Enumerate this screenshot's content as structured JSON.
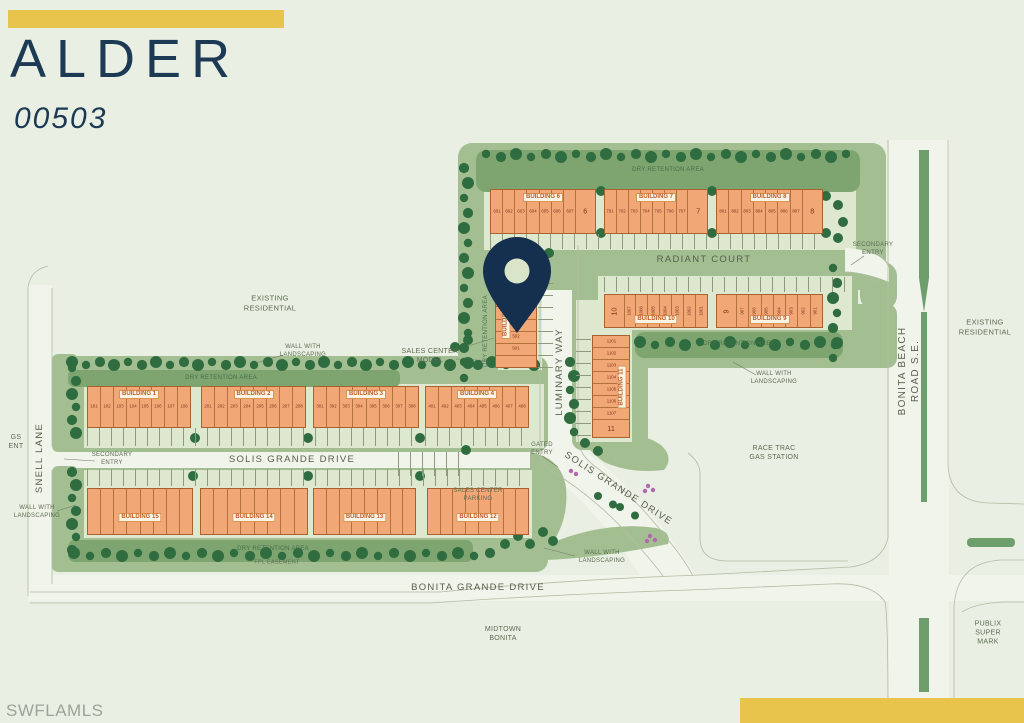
{
  "header": {
    "community_name": "ALDER",
    "unit_number": "00503"
  },
  "watermark": "SWFLAMLS",
  "colors": {
    "accent_gold": "#e9c44d",
    "navy": "#1d3a54",
    "building_orange": "#f2a777",
    "green": "#a3bf92"
  },
  "map": {
    "streets": {
      "radiant_court": "RADIANT COURT",
      "luminary_way": "LUMINARY WAY",
      "solis_grande_drive": "SOLIS GRANDE DRIVE",
      "bonita_grande_drive": "BONITA GRANDE DRIVE",
      "snell_lane": "SNELL LANE",
      "bonita_beach_road": "BONITA BEACH ROAD S.E."
    },
    "areas": {
      "existing_residential": "EXISTING\nRESIDENTIAL",
      "race_trac": "RACE TRAC\nGAS STATION",
      "publix": "PUBLIX\nSUPER MARK",
      "midtown_bonita": "MIDTOWN\nBONITA",
      "gs_ent": "GS\nENT"
    },
    "annotations": {
      "dry_retention": "DRY RETENTION AREA",
      "wall_with_landscaping": "WALL WITH\nLANDSCAPING",
      "secondary_entry": "SECONDARY\nENTRY",
      "gated_entry": "GATED\nENTRY",
      "sales_center_model": "SALES CENTER\nMODEL",
      "sales_center_parking": "SALES CENTER\nPARKING",
      "fpl_easement": "FPL EASEMENT"
    },
    "buildings": {
      "b1": {
        "label": "BUILDING 1",
        "units": [
          "101",
          "102",
          "103",
          "104",
          "105",
          "106",
          "107",
          "108"
        ]
      },
      "b2": {
        "label": "BUILDING 2",
        "units": [
          "201",
          "202",
          "203",
          "204",
          "205",
          "206",
          "207",
          "208"
        ]
      },
      "b3": {
        "label": "BUILDING 3",
        "units": [
          "301",
          "302",
          "303",
          "304",
          "305",
          "306",
          "307",
          "308"
        ]
      },
      "b4": {
        "label": "BUILDING 4",
        "units": [
          "401",
          "402",
          "403",
          "404",
          "405",
          "406",
          "407",
          "408"
        ]
      },
      "b5": {
        "label": "BUILDING 5",
        "units": [
          "",
          "",
          "",
          "",
          "503",
          "502",
          "501",
          ""
        ]
      },
      "b6": {
        "label": "BUILDING 6",
        "units": [
          "601",
          "602",
          "603",
          "604",
          "605",
          "606",
          "607",
          "6"
        ]
      },
      "b7": {
        "label": "BUILDING 7",
        "units": [
          "701",
          "702",
          "703",
          "704",
          "705",
          "706",
          "707",
          "7"
        ]
      },
      "b8": {
        "label": "BUILDING 8",
        "units": [
          "801",
          "802",
          "803",
          "804",
          "805",
          "806",
          "807",
          "8"
        ]
      },
      "b9": {
        "label": "BUILDING 9",
        "units": [
          "9",
          "907",
          "906",
          "905",
          "904",
          "903",
          "902",
          "901"
        ]
      },
      "b10": {
        "label": "BUILDING 10",
        "units": [
          "10",
          "1007",
          "1006",
          "1005",
          "1004",
          "1003",
          "1002",
          "1001"
        ]
      },
      "b11": {
        "label": "BUILDING 11",
        "units": [
          "1101",
          "1102",
          "1103",
          "1104",
          "1105",
          "1106",
          "1107",
          "11"
        ]
      },
      "b12": {
        "label": "BUILDING 12",
        "units": [
          "",
          "",
          "",
          "",
          "",
          "",
          "",
          ""
        ]
      },
      "b13": {
        "label": "BUILDING 13",
        "units": [
          "",
          "",
          "",
          "",
          "",
          "",
          "",
          ""
        ]
      },
      "b14": {
        "label": "BUILDING 14",
        "units": [
          "",
          "",
          "",
          "",
          "",
          "",
          "",
          ""
        ]
      },
      "b15": {
        "label": "BUILDING 15",
        "units": [
          "",
          "",
          "",
          "",
          "",
          "",
          "",
          ""
        ]
      }
    }
  }
}
